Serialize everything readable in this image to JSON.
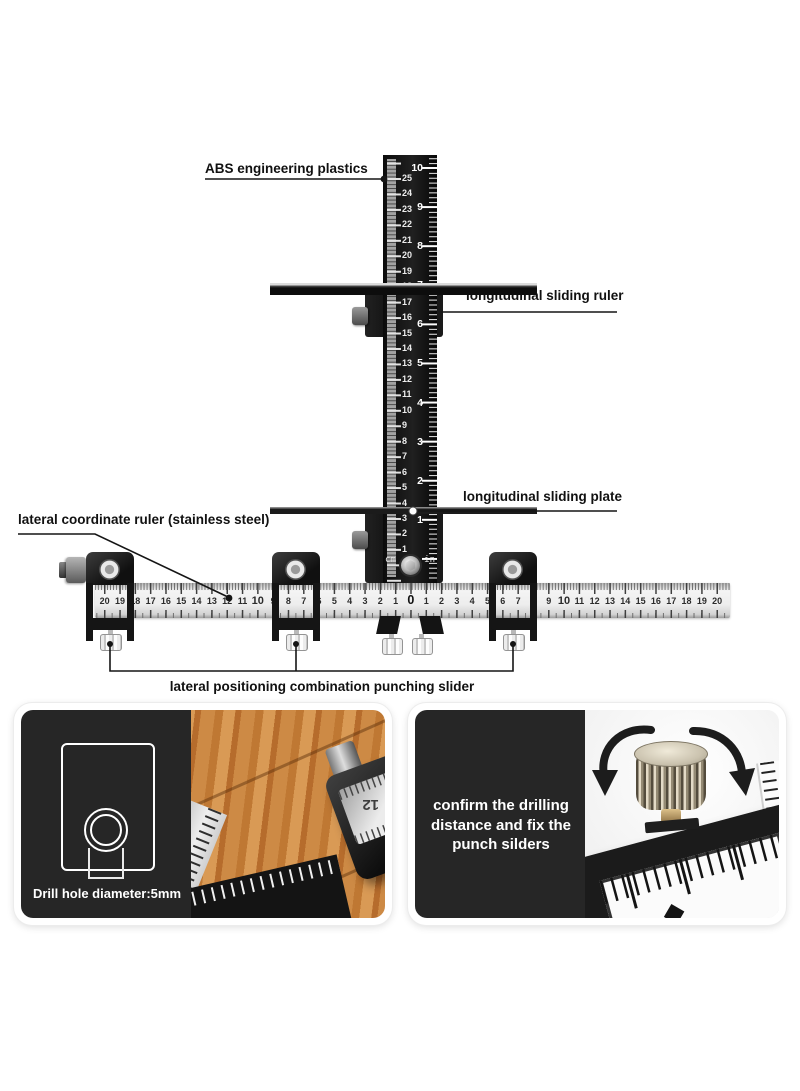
{
  "annotations": {
    "abs_plastics": "ABS engineering plastics",
    "longitudinal_sliding_ruler": "longitudinal sliding ruler",
    "longitudinal_sliding_plate": "longitudinal sliding plate",
    "lateral_coordinate_ruler": "lateral coordinate ruler (stainless steel)",
    "punching_slider": "lateral positioning combination punching slider"
  },
  "vertical_ruler": {
    "cm_numbers": [
      "25",
      "24",
      "23",
      "22",
      "21",
      "20",
      "19",
      "18",
      "17",
      "16",
      "15",
      "14",
      "13",
      "12",
      "11",
      "10",
      "9",
      "8",
      "7",
      "6",
      "5",
      "4",
      "3",
      "2",
      "1"
    ],
    "inch_numbers": [
      "10",
      "9",
      "8",
      "7",
      "6",
      "5",
      "4",
      "3",
      "2",
      "1"
    ],
    "unit_left": "cm",
    "unit_right": "in"
  },
  "horizontal_ruler": {
    "numbers": [
      "20",
      "19",
      "18",
      "17",
      "16",
      "15",
      "14",
      "13",
      "12",
      "11",
      "10",
      "9",
      "8",
      "7",
      "6",
      "5",
      "4",
      "3",
      "2",
      "1",
      "0",
      "1",
      "2",
      "3",
      "4",
      "5",
      "6",
      "7",
      "8",
      "9",
      "10",
      "11",
      "12",
      "13",
      "14",
      "15",
      "16",
      "17",
      "18",
      "19",
      "20"
    ]
  },
  "panel_drill": {
    "caption": "Drill hole diameter:5mm",
    "photo_ruler_numbers": [
      "16",
      "15",
      "14"
    ],
    "block_window_number": "12"
  },
  "panel_knob": {
    "caption": "confirm the drilling\ndistance and fix the\npunch silders",
    "side_ruler_number": "2"
  },
  "colors": {
    "tool_black": "#161616",
    "label_text": "#111111",
    "ruler_steel": "#ededed",
    "wood": "#c8813f",
    "overlay_dark": "#262626"
  }
}
